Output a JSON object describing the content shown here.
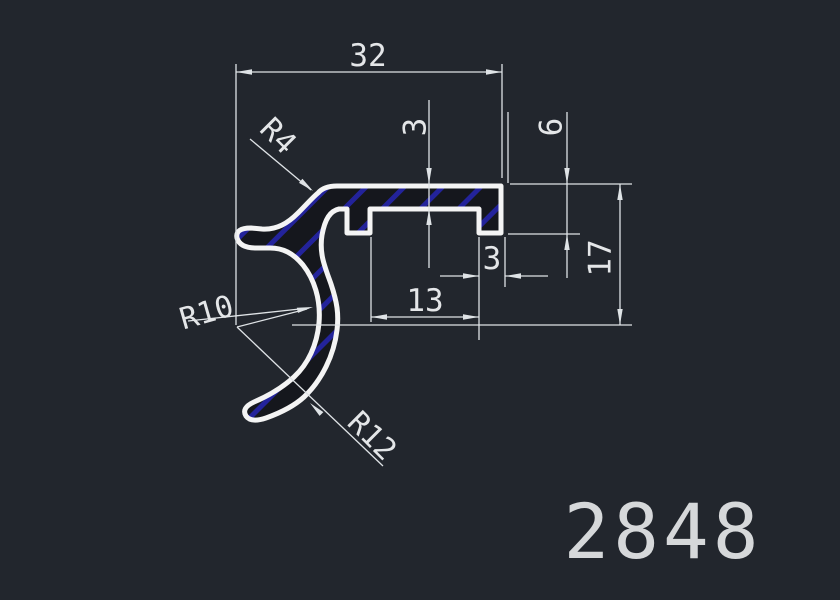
{
  "drawing": {
    "part_number": "2848",
    "type_label": "extrusion-profile-cross-section",
    "dims": {
      "overall_width": "32",
      "plate_thickness": "3",
      "step_height": "6",
      "overall_height": "17",
      "foot_width": "3",
      "slot_width": "13",
      "fillet_radius": "R4",
      "inner_radius": "R10",
      "outer_radius": "R12"
    }
  },
  "theme": {
    "bg": "#22262d",
    "line": "#f4f4f4",
    "dim": "#dfe3e6",
    "hatch": "#23239b",
    "profile-fill": "#15171d",
    "text": "#e4e6e8",
    "partnum": "#d6d8da"
  }
}
